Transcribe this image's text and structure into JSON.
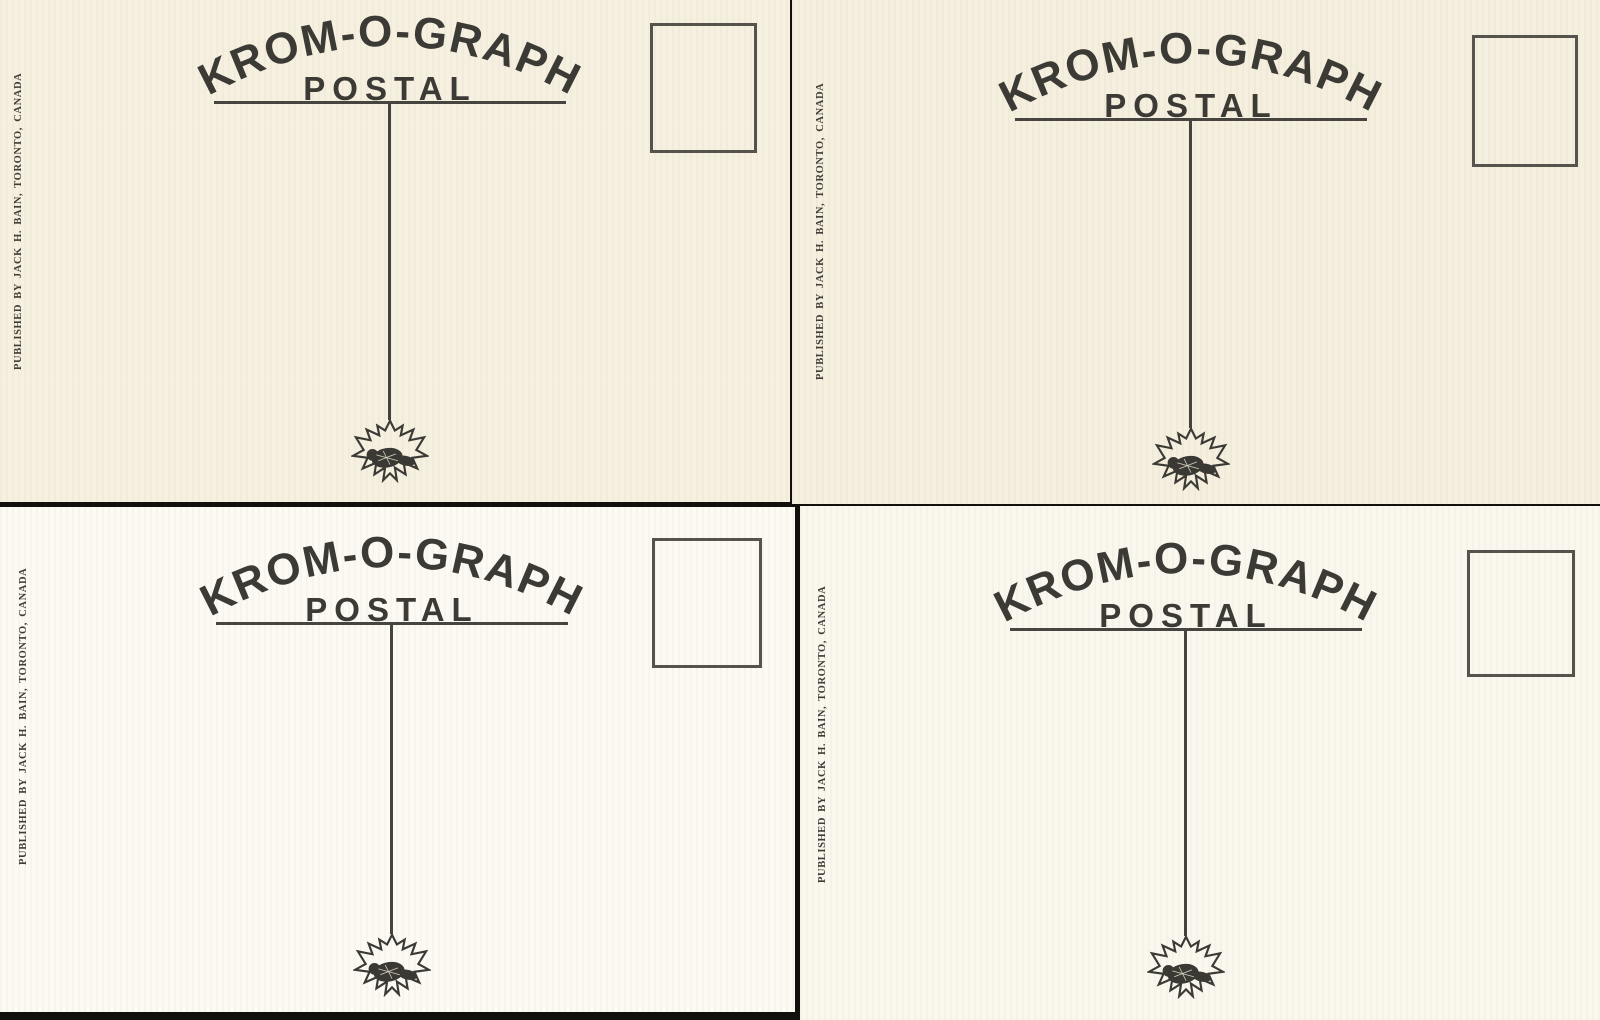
{
  "colors": {
    "ink": "#3b3a35",
    "paper_cream": "#f6f0e1",
    "paper_white": "#fcfaf3",
    "scan_background": "#12100c",
    "stamp_box_border": "#55534c"
  },
  "icons": {
    "emblem": "maple-leaf-beaver-icon"
  },
  "cards": [
    {
      "position": "top-left",
      "brand_title": "KROM-O-GRAPH",
      "brand_subtitle": "POSTAL",
      "publisher_line": "PUBLISHED BY JACK H. BAIN, TORONTO, CANADA"
    },
    {
      "position": "top-right",
      "brand_title": "KROM-O-GRAPH",
      "brand_subtitle": "POSTAL",
      "publisher_line": "PUBLISHED BY JACK H. BAIN, TORONTO, CANADA"
    },
    {
      "position": "bottom-left",
      "brand_title": "KROM-O-GRAPH",
      "brand_subtitle": "POSTAL",
      "publisher_line": "PUBLISHED BY JACK H. BAIN, TORONTO, CANADA"
    },
    {
      "position": "bottom-right",
      "brand_title": "KROM-O-GRAPH",
      "brand_subtitle": "POSTAL",
      "publisher_line": "PUBLISHED BY JACK H. BAIN, TORONTO, CANADA"
    }
  ]
}
